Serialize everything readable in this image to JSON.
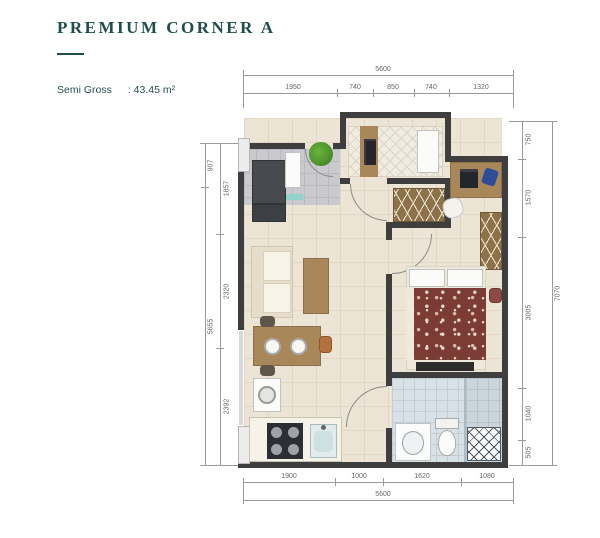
{
  "header": {
    "title": "PREMIUM CORNER A",
    "area_label": "Semi Gross",
    "area_value": ": 43.45 m²"
  },
  "dimensions": {
    "top": {
      "overall": "5600",
      "segments": [
        "1950",
        "740",
        "850",
        "740",
        "1320"
      ]
    },
    "bottom": {
      "overall": "5600",
      "segments": [
        "1900",
        "1000",
        "1620",
        "1080"
      ]
    },
    "left": {
      "outer": [
        "907",
        "5655"
      ],
      "inner": [
        "1857",
        "2320",
        "2392"
      ]
    },
    "right": {
      "overall": "7070",
      "segments": [
        "750",
        "1570",
        "3005",
        "1040",
        "505"
      ]
    }
  },
  "colors": {
    "accent_teal": "#1d4d4c",
    "wall": "#3e3e3e",
    "floor_cream": "#ece5d5",
    "entry_tile": "#c9c9ce",
    "bath_tile": "#d8e1e6",
    "wood": "#a8875a",
    "bed_maroon": "#7b3c35",
    "plant_green": "#4da12f",
    "dim_line": "#9a9a9a"
  }
}
